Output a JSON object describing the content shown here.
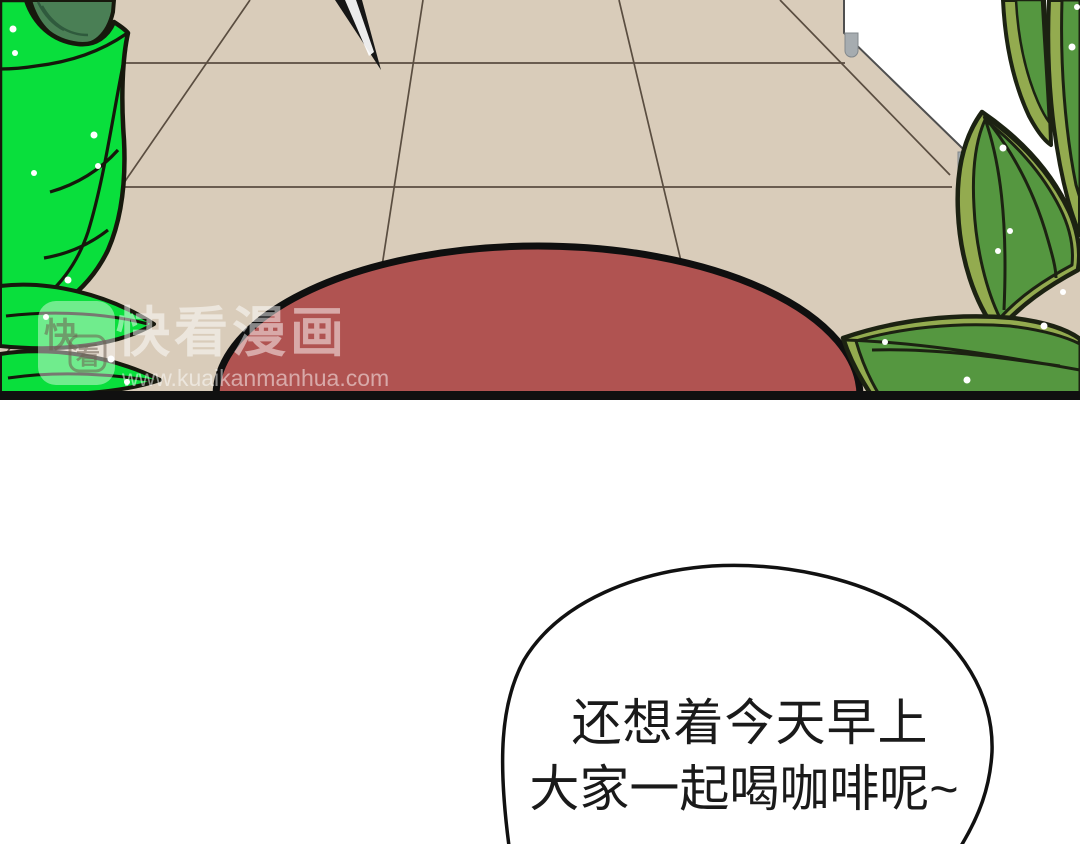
{
  "comic": {
    "watermark": {
      "brand": "快看漫画",
      "url": "www.kuaikanmanhua.com",
      "logo_char_1": "快",
      "logo_char_2": "看"
    },
    "speech_bubble": {
      "line1": "还想着今天早上",
      "line2": "大家一起喝咖啡呢~"
    },
    "palette": {
      "floor": "#d9ccba",
      "tile_line": "#5a4d40",
      "dome_red": "#b05351",
      "leaf_bright_green": "#09df3c",
      "leaf_dark_green": "#4a7f55",
      "leaf_olive": "#93ab4f",
      "leaf_green": "#559740",
      "white_shape": "#ffffff",
      "gray_tab": "#a6acb0",
      "outline_black": "#141414",
      "watermark_white": "rgba(255,255,255,0.5)"
    }
  }
}
